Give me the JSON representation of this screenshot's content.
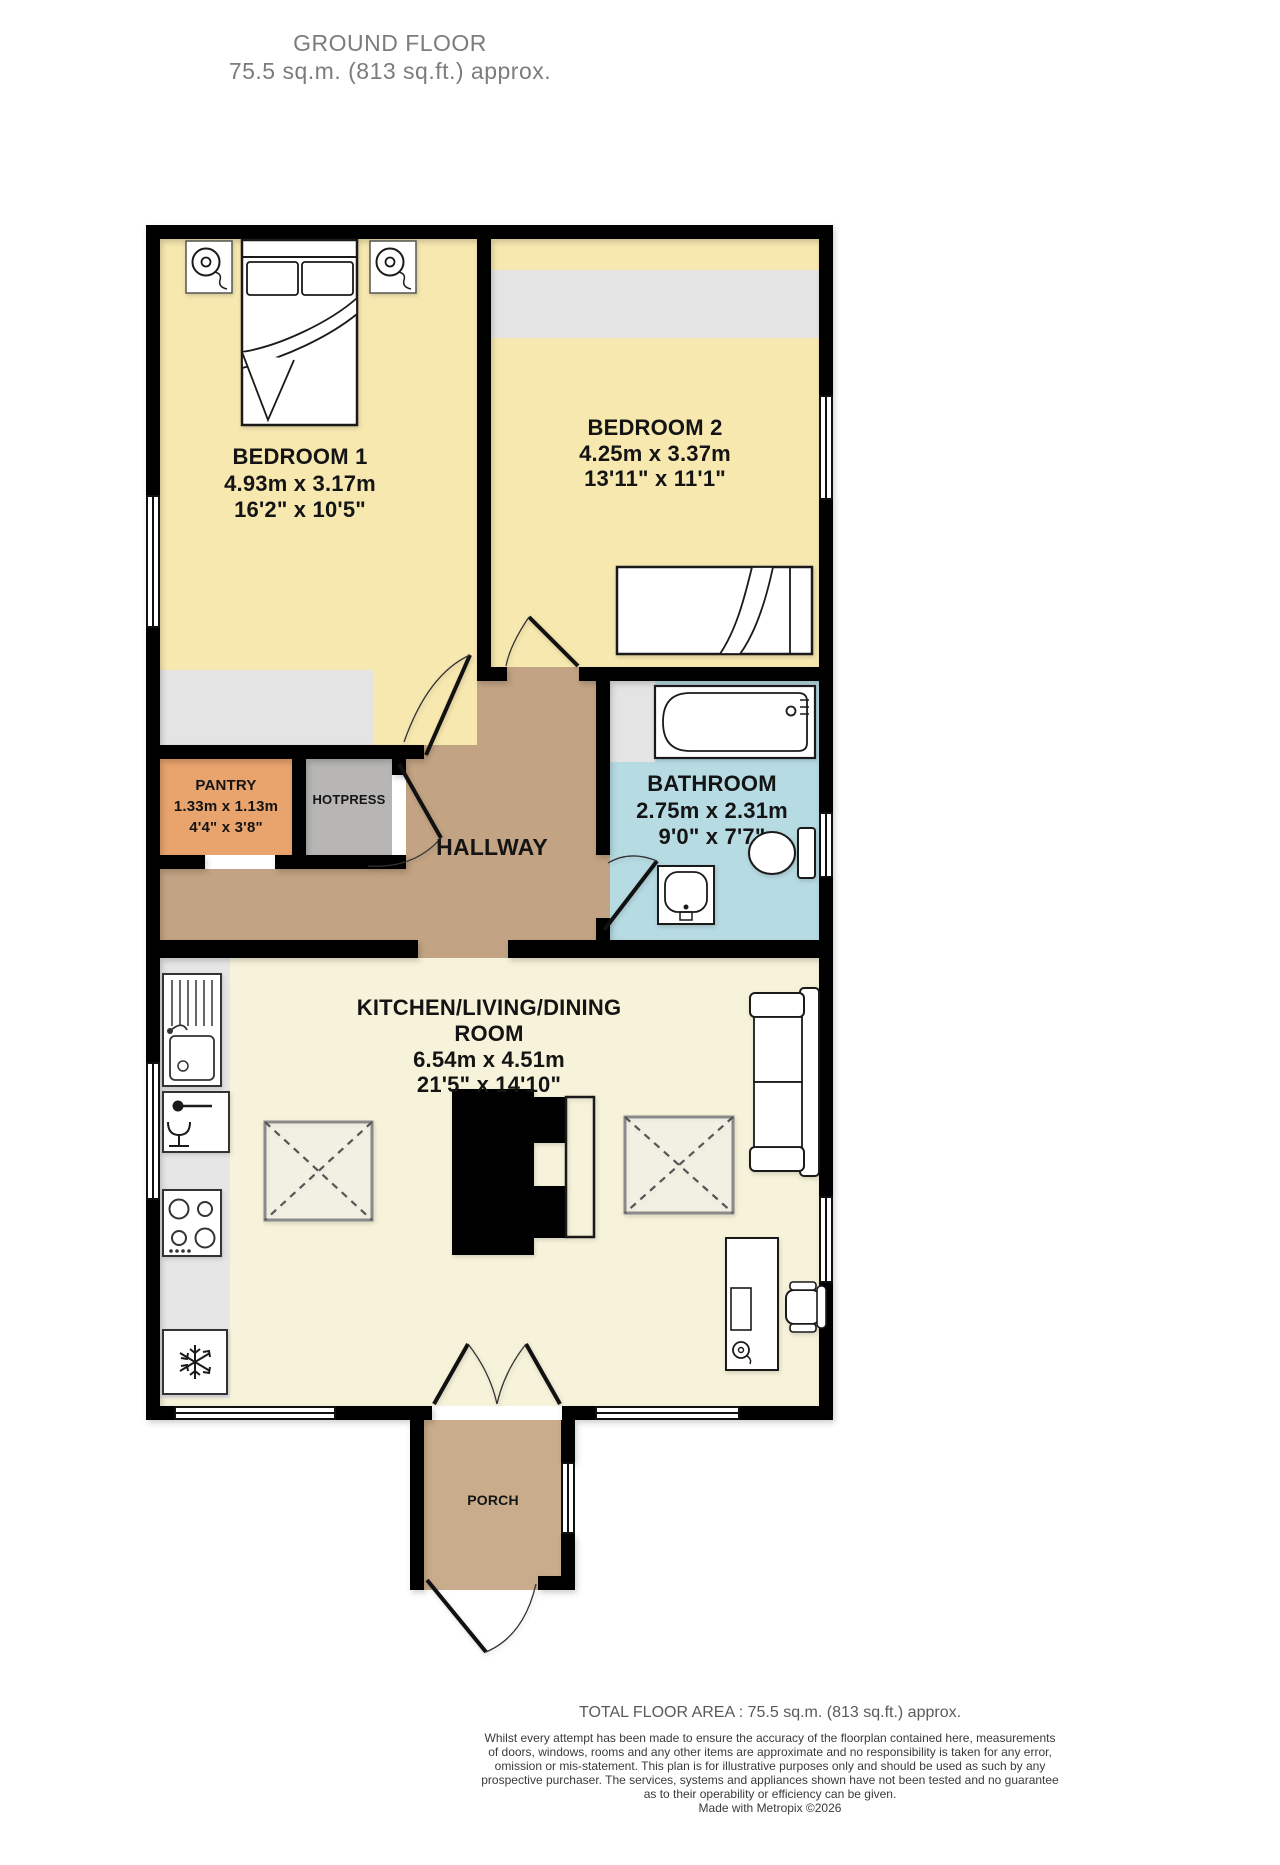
{
  "title": {
    "line1": "GROUND FLOOR",
    "line2": "75.5 sq.m. (813 sq.ft.) approx."
  },
  "rooms": {
    "bedroom1": {
      "name": "BEDROOM 1",
      "metric": "4.93m  x 3.17m",
      "imperial": "16'2\"  x 10'5\""
    },
    "bedroom2": {
      "name": "BEDROOM 2",
      "metric": "4.25m  x 3.37m",
      "imperial": "13'11\"  x 11'1\""
    },
    "bathroom": {
      "name": "BATHROOM",
      "metric": "2.75m  x 2.31m",
      "imperial": "9'0\"  x 7'7\""
    },
    "pantry": {
      "name": "PANTRY",
      "metric": "1.33m  x 1.13m",
      "imperial": "4'4\"  x 3'8\""
    },
    "hotpress": {
      "name": "HOTPRESS"
    },
    "hallway": {
      "name": "HALLWAY"
    },
    "kitchen": {
      "name_line1": "KITCHEN/LIVING/DINING",
      "name_line2": "ROOM",
      "metric": "6.54m  x 4.51m",
      "imperial": "21'5\"  x 14'10\""
    },
    "porch": {
      "name": "PORCH"
    }
  },
  "footer": {
    "total": "TOTAL FLOOR AREA : 75.5 sq.m. (813 sq.ft.) approx.",
    "disclaimer_lines": [
      "Whilst every attempt has been made to ensure the accuracy of the floorplan contained here, measurements",
      "of doors, windows, rooms and any other items are approximate and no responsibility is taken for any error,",
      "omission or mis-statement. This plan is for illustrative purposes only and should be used as such by any",
      "prospective purchaser. The services, systems and appliances shown have not been tested and no guarantee",
      "as to their operability or efficiency can be given."
    ],
    "credit": "Made with Metropix ©2026"
  },
  "colors": {
    "wall": "#000000",
    "bedroom_floor": "#f7e8b0",
    "kitchen_floor": "#f7f3da",
    "bathroom_floor": "#b7dbe3",
    "hallway_floor": "#c2a383",
    "porch_floor": "#c9ac8c",
    "pantry_floor": "#e9a36d",
    "hotpress_floor": "#b7b6b5",
    "wardrobe_strip": "#e4e4e4",
    "counter_strip": "#e6e6e6",
    "title_text": "#7c7c7c",
    "label_text": "#141414",
    "footer_text": "#3a3a3a"
  }
}
